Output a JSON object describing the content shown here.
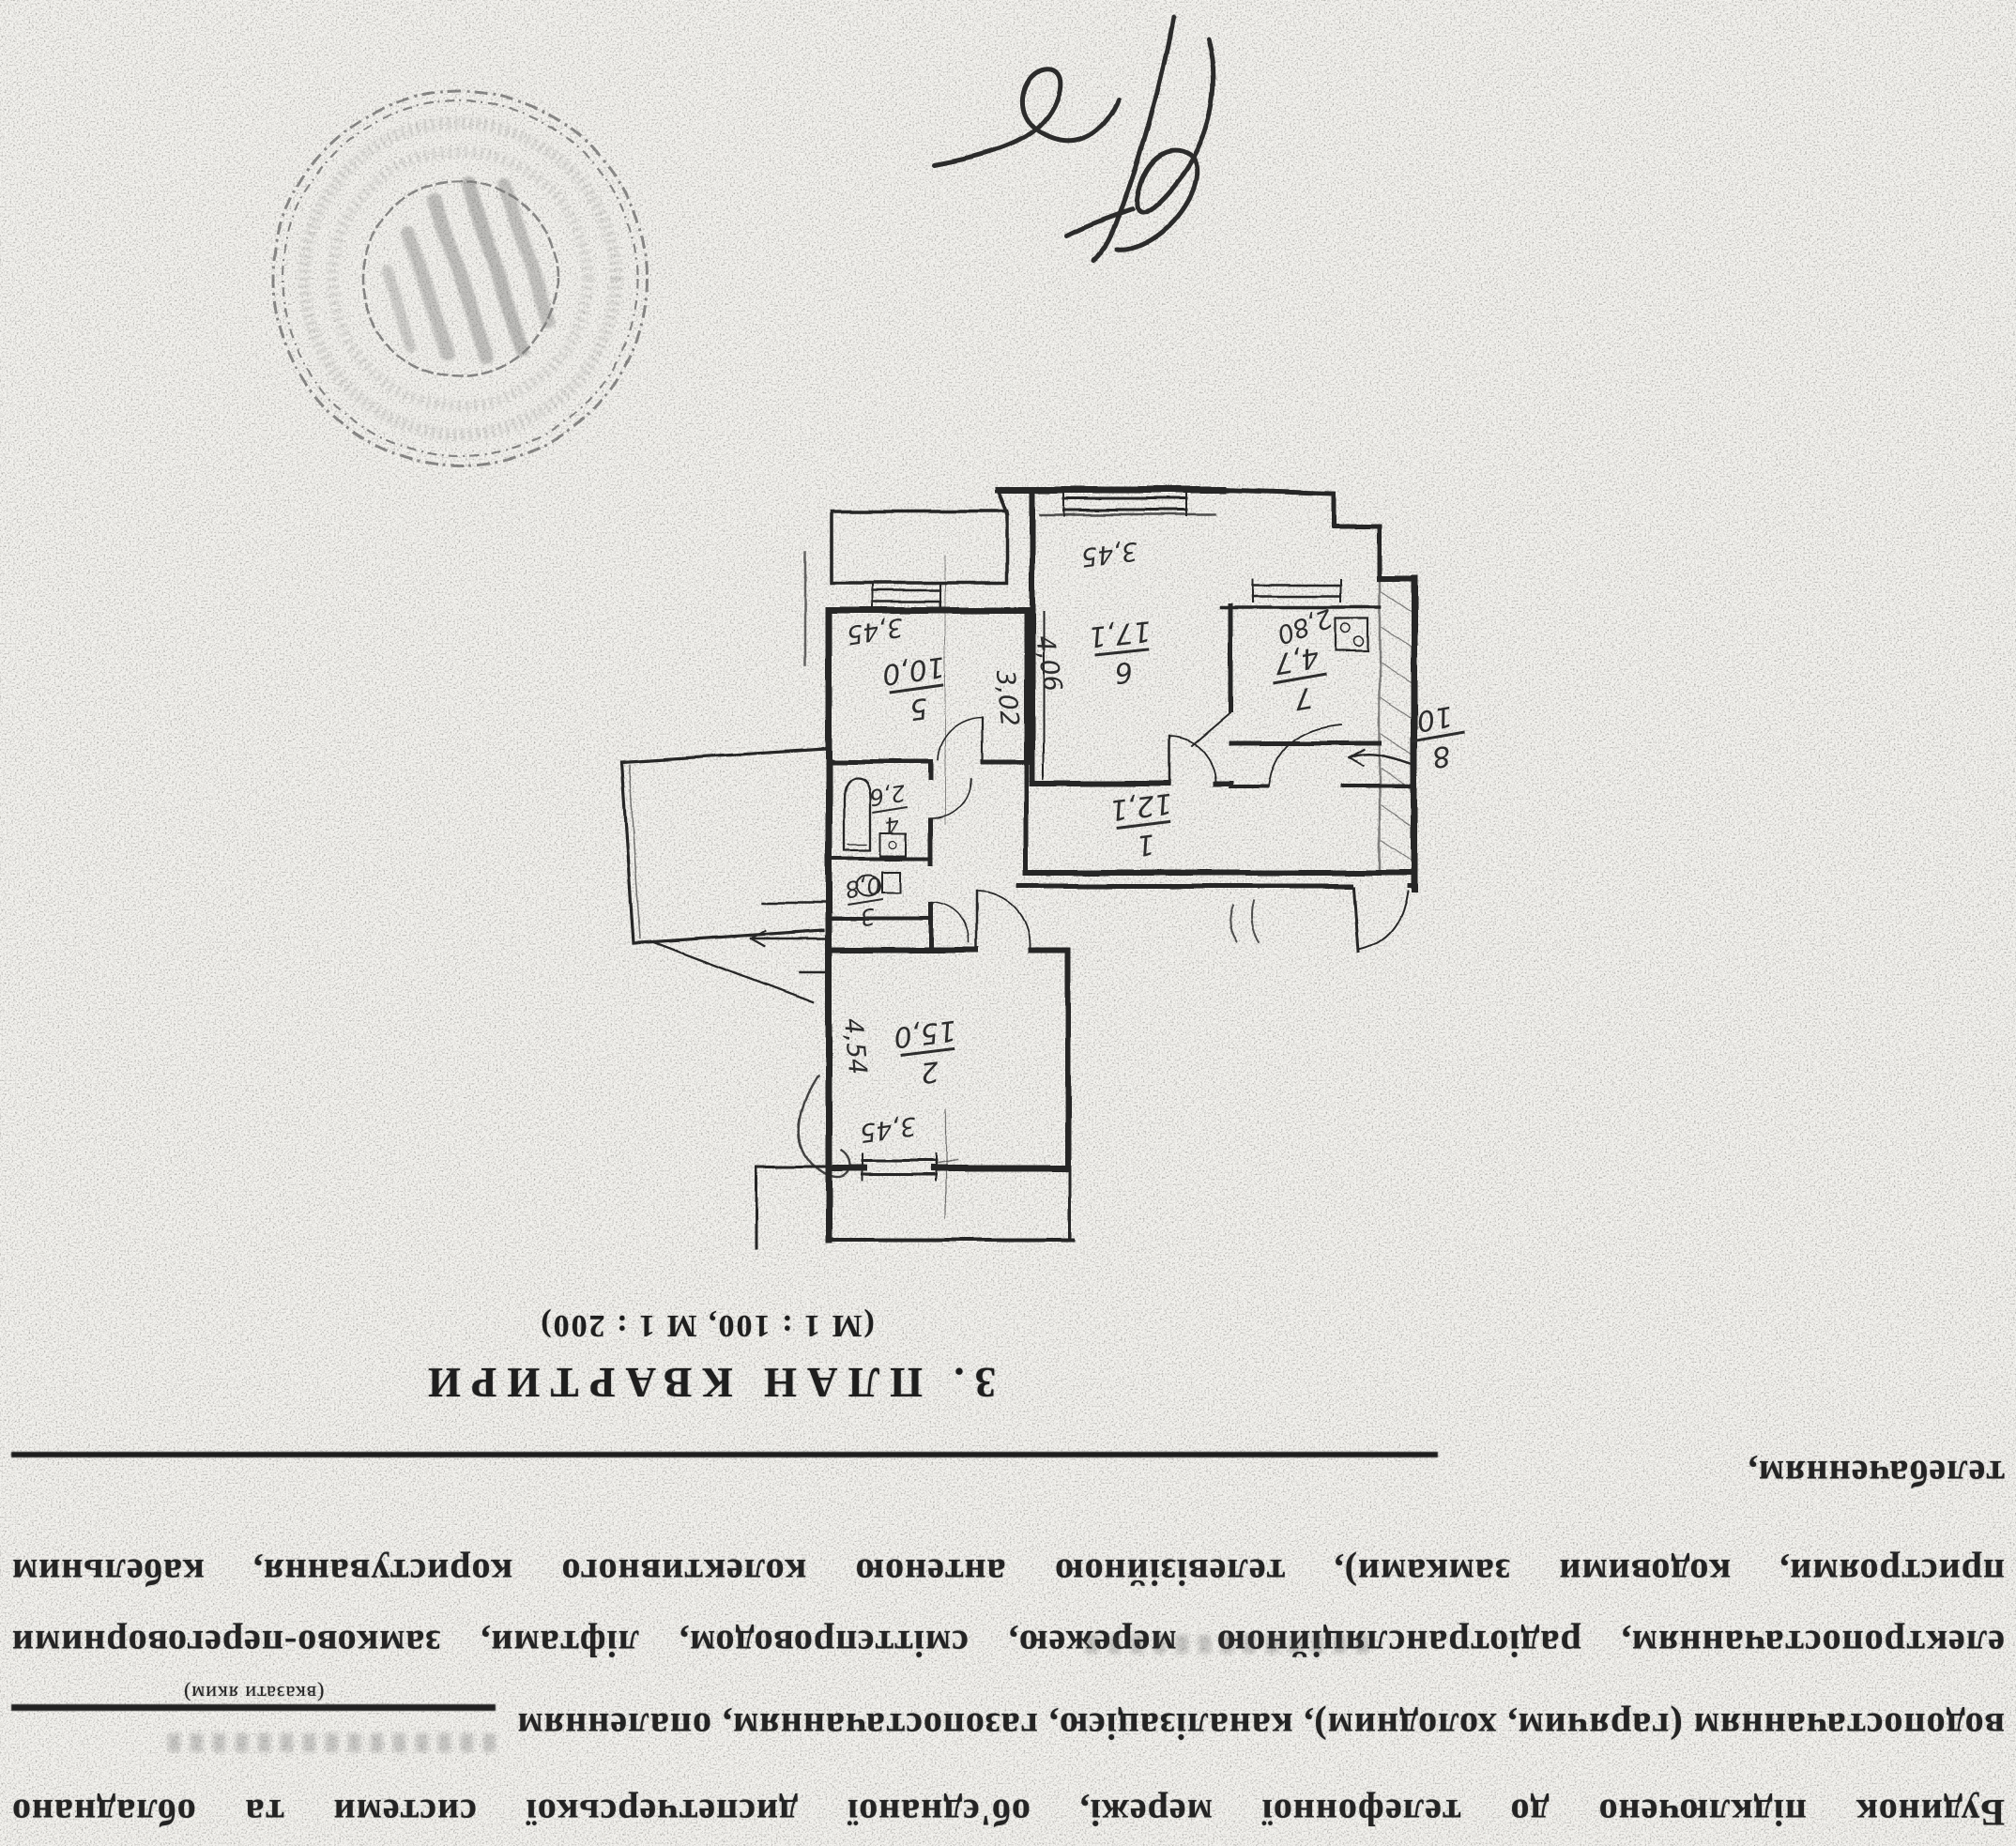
{
  "document": {
    "section_title": "3. ПЛАН КВАРТИРИ",
    "scale_note": "(М 1 : 100, М 1 : 200)"
  },
  "paragraph": {
    "line_building": "Будинок підключено до телефонної мережі, об'єднаної диспетчерської системи та обладнано",
    "line_utilities": "водопостачанням (гарячим, холодним), каналізацією, газопостачанням, опаленням",
    "blank_hint": "(вказати яким)",
    "line_electric": "електропостачанням, радіотрансляційною мережею, сміттєпроводом, ліфтами, замково-переговорними",
    "line_devices": "пристроями, кодовими замками), телевізійною антеною колективного користування, кабельним",
    "line_tv": "телебаченням,"
  },
  "plan": {
    "rooms": {
      "corridor": {
        "number": "1",
        "area": "12,1"
      },
      "room2": {
        "number": "2",
        "area": "15,0",
        "dim_width": "3,45",
        "dim_length": "4,54"
      },
      "wc": {
        "number": "3",
        "area": "0,8"
      },
      "bath": {
        "number": "4",
        "area": "2,6"
      },
      "room5": {
        "number": "5",
        "area": "10,0",
        "dim_width": "3,45",
        "dim_length": "3,02"
      },
      "room6": {
        "number": "6",
        "area": "17,1",
        "dim_width": "3,45",
        "dim_length": "4,06"
      },
      "kitchen": {
        "number": "7",
        "area": "4,7",
        "dim_width": "2,80"
      }
    },
    "entry_mark": {
      "top": "8",
      "bottom": "10"
    }
  }
}
